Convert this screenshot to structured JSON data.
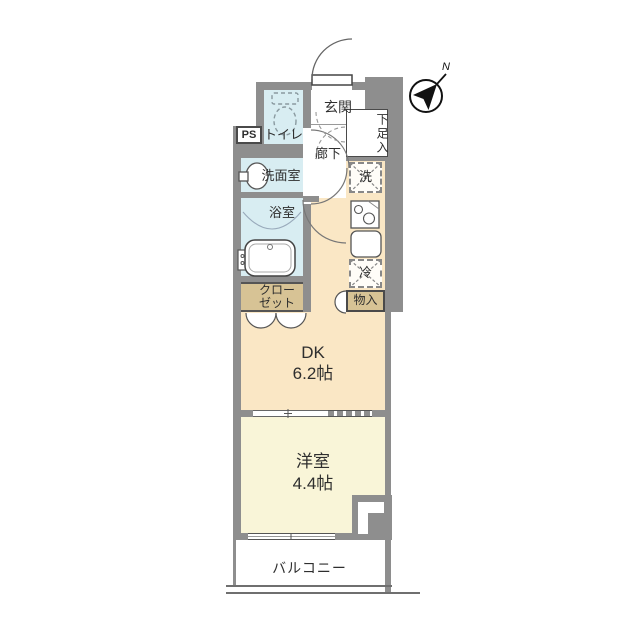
{
  "plan": {
    "entrance": "玄関",
    "hallway": "廊下",
    "toilet": "トイレ",
    "washroom": "洗面室",
    "bathroom": "浴室",
    "shoe_cabinet": "下足入",
    "washer_space": "洗",
    "fridge_space": "冷",
    "storage": "物入",
    "closet_line1": "クロー",
    "closet_line2": "ゼット",
    "pipe_space": "PS",
    "dk_name": "DK",
    "dk_size": "6.2帖",
    "western_room_name": "洋室",
    "western_room_size": "4.4帖",
    "balcony": "バルコニー"
  },
  "compass": {
    "north_label": "N"
  },
  "colors": {
    "wall": "#8e8e8e",
    "wet_rooms": "#d8edf2",
    "dining_kitchen": "#fae7c5",
    "western_room": "#f9f5d8",
    "closet": "#d7c395",
    "outline": "#4a4a4a"
  }
}
